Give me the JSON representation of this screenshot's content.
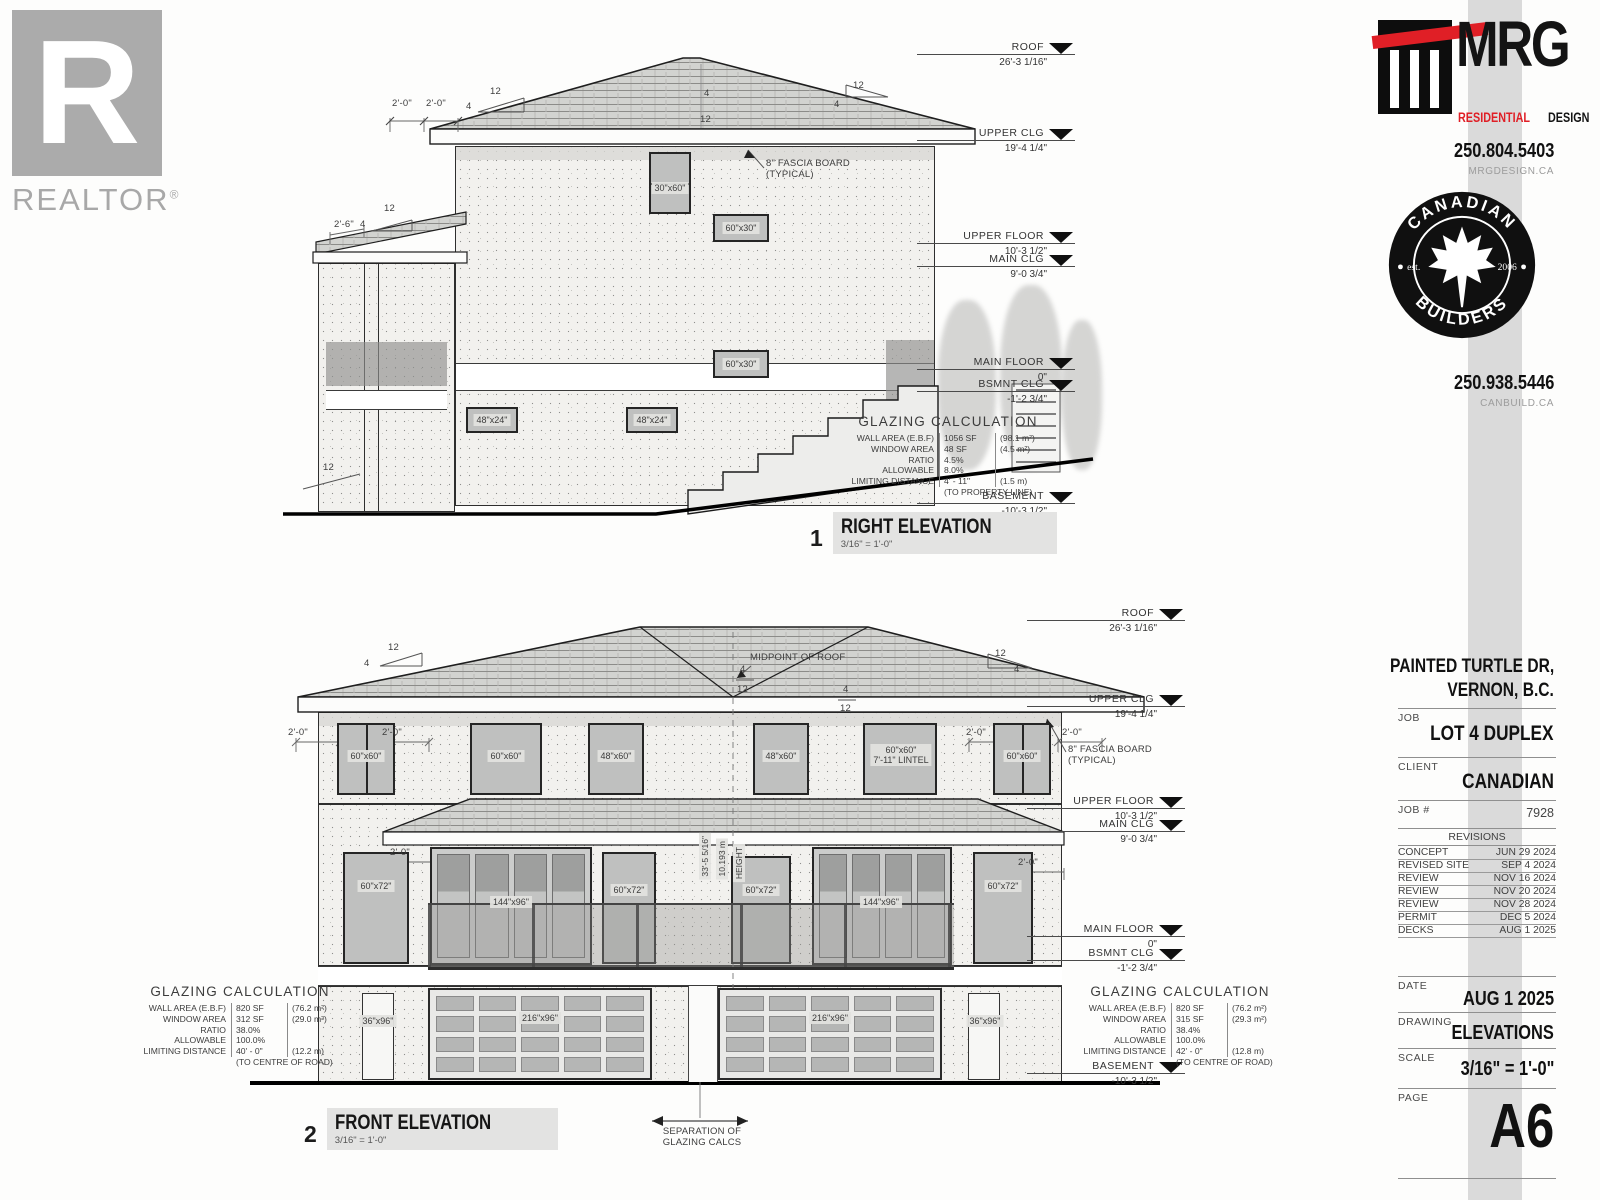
{
  "sheet": {
    "watermark_word": "REALTOR",
    "watermark_reg": "®",
    "watermark_letter": "R"
  },
  "branding": {
    "mrg": {
      "name": "MRG",
      "line1": "RESIDENTIAL",
      "line2": "DESIGN",
      "phone": "250.804.5403",
      "website": "MRGDESIGN.CA"
    },
    "canadian_builders": {
      "arc_top": "CANADIAN",
      "arc_bottom": "BUILDERS",
      "est": "est.",
      "year": "2006",
      "phone": "250.938.5446",
      "website": "CANBUILD.CA"
    }
  },
  "title_block": {
    "address_line1": "PAINTED TURTLE DR,",
    "address_line2": "VERNON, B.C.",
    "job_label": "JOB",
    "job": "LOT 4 DUPLEX",
    "client_label": "CLIENT",
    "client": "CANADIAN",
    "job_no_label": "JOB #",
    "job_no": "7928",
    "revisions_title": "REVISIONS",
    "revisions": [
      {
        "name": "CONCEPT",
        "date": "JUN 29 2024"
      },
      {
        "name": "REVISED SITE",
        "date": "SEP 4 2024"
      },
      {
        "name": "REVIEW",
        "date": "NOV 16 2024"
      },
      {
        "name": "REVIEW",
        "date": "NOV 20 2024"
      },
      {
        "name": "REVIEW",
        "date": "NOV 28 2024"
      },
      {
        "name": "PERMIT",
        "date": "DEC 5 2024"
      },
      {
        "name": "DECKS",
        "date": "AUG 1 2025"
      }
    ],
    "date_label": "DATE",
    "date": "AUG 1 2025",
    "drawing_label": "DRAWING",
    "drawing": "ELEVATIONS",
    "scale_label": "SCALE",
    "scale": "3/16\" = 1'-0\"",
    "page_label": "PAGE",
    "page": "A6"
  },
  "levels": [
    {
      "name": "ROOF",
      "dim": "26'-3 1/16\""
    },
    {
      "name": "UPPER CLG",
      "dim": "19'-4 1/4\""
    },
    {
      "name": "UPPER FLOOR",
      "dim": "10'-3 1/2\""
    },
    {
      "name": "MAIN CLG",
      "dim": "9'-0 3/4\""
    },
    {
      "name": "MAIN FLOOR",
      "dim": "0\""
    },
    {
      "name": "BSMNT CLG",
      "dim": "-1'-2 3/4\""
    },
    {
      "name": "BASEMENT",
      "dim": "-10'-3 1/2\""
    }
  ],
  "notes": {
    "fascia_line1": "8\" FASCIA BOARD",
    "fascia_line2": "(TYPICAL)",
    "pitch_run": "12",
    "pitch_rise": "4",
    "dim_2ft": "2'-0\"",
    "dim_2ft6": "2'-6\""
  },
  "right_elevation": {
    "number": "1",
    "title": "RIGHT ELEVATION",
    "scale": "3/16\" = 1'-0\"",
    "windows": {
      "w_30x60": "30\"x60\"",
      "w_60x30": "60\"x30\"",
      "w_48x24": "48\"x24\""
    },
    "glazing": {
      "title": "GLAZING CALCULATION",
      "rows": [
        {
          "label": "WALL AREA (E.B.F)",
          "value": "1056 SF",
          "metric": "(98.1 m²)"
        },
        {
          "label": "WINDOW AREA",
          "value": "48 SF",
          "metric": "(4.5 m²)"
        },
        {
          "label": "RATIO",
          "value": "4.5%",
          "metric": ""
        },
        {
          "label": "ALLOWABLE",
          "value": "8.0%",
          "metric": ""
        },
        {
          "label": "LIMITING DISTANCE",
          "value": "4' - 11\"",
          "metric": "(1.5 m)"
        }
      ],
      "note": "(TO PROPERTY LINE)"
    }
  },
  "front_elevation": {
    "number": "2",
    "title": "FRONT ELEVATION",
    "scale": "3/16\" = 1'-0\"",
    "midpoint_label": "MIDPOINT OF ROOF",
    "height_dim": "33'-5 5/16\"",
    "height_metric": "10.193 m",
    "height_word": "HEIGHT",
    "windows": {
      "w_60x60": "60\"x60\"",
      "w_48x60": "48\"x60\"",
      "lintel": "7'-11\" LINTEL",
      "w_60x72": "60\"x72\"",
      "w_144x96": "144\"x96\"",
      "w_216x96": "216\"x96\"",
      "w_36x96": "36\"x96\""
    },
    "separation_line1": "SEPARATION OF",
    "separation_line2": "GLAZING CALCS",
    "glazing_left": {
      "title": "GLAZING CALCULATION",
      "rows": [
        {
          "label": "WALL AREA (E.B.F)",
          "value": "820 SF",
          "metric": "(76.2 m²)"
        },
        {
          "label": "WINDOW AREA",
          "value": "312 SF",
          "metric": "(29.0 m²)"
        },
        {
          "label": "RATIO",
          "value": "38.0%",
          "metric": ""
        },
        {
          "label": "ALLOWABLE",
          "value": "100.0%",
          "metric": ""
        },
        {
          "label": "LIMITING DISTANCE",
          "value": "40' - 0\"",
          "metric": "(12.2 m)"
        }
      ],
      "note": "(TO CENTRE OF ROAD)"
    },
    "glazing_right": {
      "title": "GLAZING CALCULATION",
      "rows": [
        {
          "label": "WALL AREA (E.B.F)",
          "value": "820 SF",
          "metric": "(76.2 m²)"
        },
        {
          "label": "WINDOW AREA",
          "value": "315 SF",
          "metric": "(29.3 m²)"
        },
        {
          "label": "RATIO",
          "value": "38.4%",
          "metric": ""
        },
        {
          "label": "ALLOWABLE",
          "value": "100.0%",
          "metric": ""
        },
        {
          "label": "LIMITING DISTANCE",
          "value": "42' - 0\"",
          "metric": "(12.8 m)"
        }
      ],
      "note": "(TO CENTRE OF ROAD)"
    }
  }
}
